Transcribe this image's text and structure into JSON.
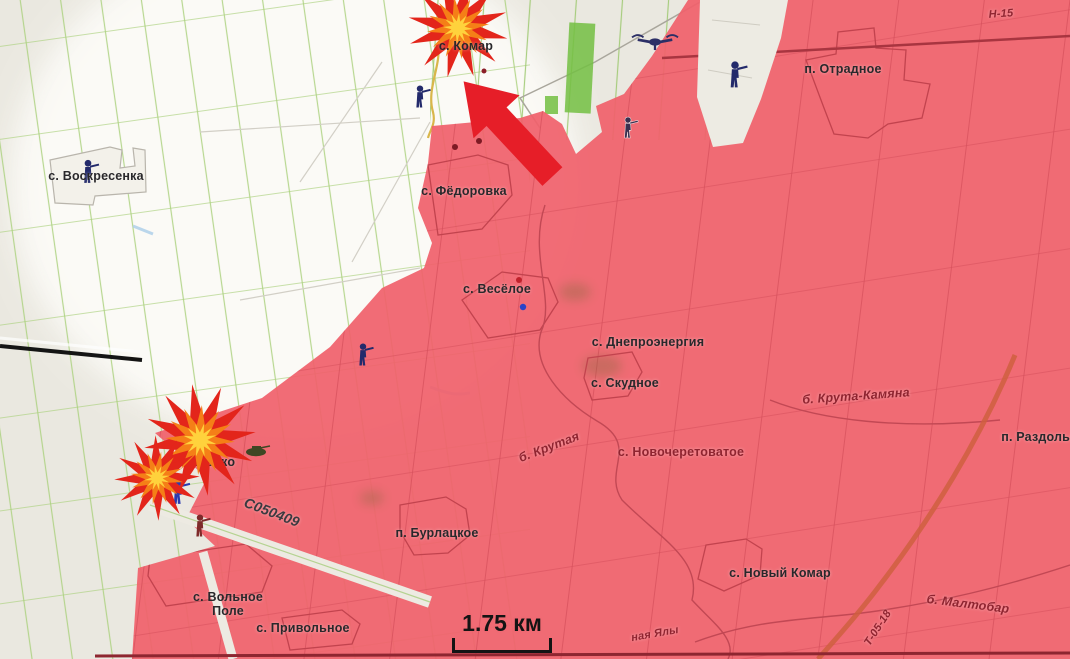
{
  "map": {
    "description": "frontline-situation-map",
    "scale_bar": {
      "label": "1.75 км"
    },
    "labels": [
      {
        "id": "komar",
        "text": "с. Комар"
      },
      {
        "id": "otradnoe",
        "text": "п. Отрадное"
      },
      {
        "id": "h15",
        "text": "Н-15"
      },
      {
        "id": "voskresenka",
        "text": "с. Воскресенка"
      },
      {
        "id": "fedorovka",
        "text": "с. Фёдоровка"
      },
      {
        "id": "veseloe",
        "text": "с. Весёлое"
      },
      {
        "id": "dneproenergia",
        "text": "с. Днепроэнергия"
      },
      {
        "id": "skudnoe",
        "text": "с. Скудное"
      },
      {
        "id": "kruta-kamyana",
        "text": "б. Крута-Камяна"
      },
      {
        "id": "razdolnoe",
        "text": "п. Раздольное"
      },
      {
        "id": "novocheretovatoe",
        "text": "с. Новочеретоватое"
      },
      {
        "id": "krutaya",
        "text": "б. Крутая"
      },
      {
        "id": "burlatskoe",
        "text": "п. Бурлацкое"
      },
      {
        "id": "shevchenko",
        "text": "с. Шевченко"
      },
      {
        "id": "c050409",
        "text": "С050409"
      },
      {
        "id": "volnoe-pole",
        "text": "с. Вольное Поле"
      },
      {
        "id": "privolnoe",
        "text": "с. Привольное"
      },
      {
        "id": "novy-komar",
        "text": "с. Новый Комар"
      },
      {
        "id": "maltobar",
        "text": "б. Малтобар"
      },
      {
        "id": "t0518",
        "text": "Т-05-18"
      },
      {
        "id": "yaly",
        "text": "ная Ялы"
      }
    ],
    "icons": [
      "explosion-icon",
      "explosion-icon",
      "explosion-icon",
      "attack-arrow-icon",
      "drone-icon",
      "soldier-icon",
      "soldier-icon",
      "soldier-icon",
      "soldier-icon",
      "soldier-icon",
      "soldier-icon",
      "soldier-icon",
      "tank-icon"
    ],
    "colors": {
      "red_zone": "#f0616c",
      "red_zone_lines": "#d6505c",
      "highlight_zone": "#fcfbf7",
      "base_map": "#eae8e0",
      "field_line_green": "#abd17e",
      "attack_arrow": "#e61e28",
      "explosion_outer": "#e3251b",
      "explosion_mid": "#f57f17",
      "explosion_core": "#ffd23c",
      "unit_icon": "#232a6b",
      "forest_strip": "#74c043",
      "label_dark": "#29282b",
      "label_red": "#8f2430"
    }
  }
}
